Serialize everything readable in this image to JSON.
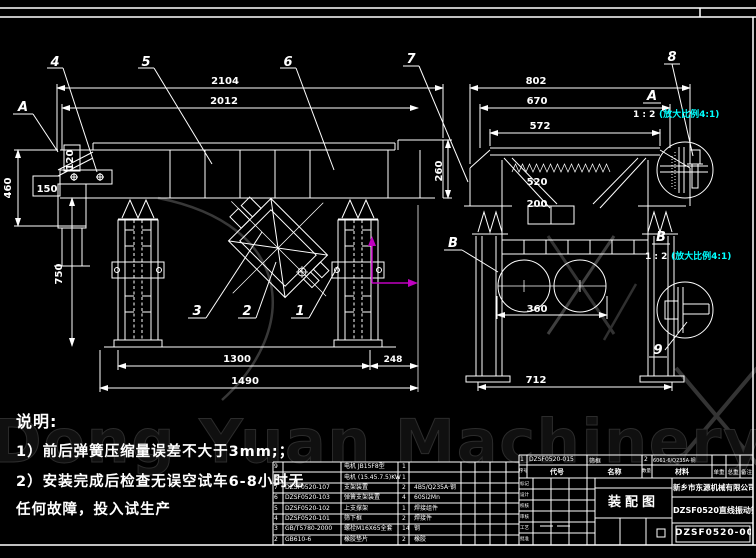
{
  "watermark": {
    "text": "Dong Yuan Machinery"
  },
  "notes": {
    "title": "说明:",
    "line1": "1）前后弹簧压缩量误差不大于3mm;；",
    "line2": "2）安装完成后检查无误空试车6-8小时无",
    "line3": "任何故障，投入试生产"
  },
  "side_view": {
    "marker_a": "A",
    "balloons": {
      "b1": "1",
      "b2": "2",
      "b3": "3",
      "b4": "4",
      "b5": "5",
      "b6": "6"
    },
    "dims": {
      "d2104": "2104",
      "d2012": "2012",
      "d460": "460",
      "d120": "120",
      "d150": "150",
      "d260": "260",
      "d750": "750",
      "d1300": "1300",
      "d248": "248",
      "d1490": "1490"
    }
  },
  "front_view": {
    "marker_b": "B",
    "balloons": {
      "b7": "7"
    },
    "dims": {
      "d802": "802",
      "d670": "670",
      "d572": "572",
      "d520": "520",
      "d200": "200",
      "d360": "360",
      "d712": "712"
    }
  },
  "details": {
    "a": {
      "label": "A",
      "scale": "1 : 2",
      "note": "(放大比例4:1)",
      "balloon": "8"
    },
    "b": {
      "label": "B",
      "scale": "1 : 2",
      "note": "(放大比例4:1)",
      "balloon": "9"
    }
  },
  "bom": {
    "rows": [
      {
        "no": "9",
        "code": "",
        "name": "电机 JB15F8型",
        "qty": "1",
        "material": ""
      },
      {
        "no": "8",
        "code": "",
        "name": "电机 (15.45.7.5)KW",
        "qty": "1",
        "material": ""
      },
      {
        "no": "7",
        "code": "DZSF0520-107",
        "name": "支架装置",
        "qty": "2",
        "material": "4B5/Q235A·钢"
      },
      {
        "no": "6",
        "code": "DZSF0520-103",
        "name": "弹簧支架装置",
        "qty": "4",
        "material": "60Si2Mn"
      },
      {
        "no": "5",
        "code": "DZSF0520-102",
        "name": "上支撑架",
        "qty": "1",
        "material": "焊接组件"
      },
      {
        "no": "4",
        "code": "DZSF0520-101",
        "name": "筛下框",
        "qty": "2",
        "material": "焊接件"
      },
      {
        "no": "3",
        "code": "GB/T5780-2000",
        "name": "螺栓M16X65全套",
        "qty": "14",
        "material": "钢"
      },
      {
        "no": "2",
        "code": "GB610-6",
        "name": "橡胶垫片",
        "qty": "2",
        "material": "橡胶"
      }
    ]
  },
  "title_block": {
    "row1": {
      "no": "1",
      "code": "DZSF0520-015",
      "name": "筛框",
      "qty": "2",
      "material": "6061·6/Q235A·钢"
    },
    "header": {
      "no": "序号",
      "code": "代号",
      "name": "名称",
      "qty": "数量",
      "material": "材料",
      "unit_weight": "单重",
      "total_weight": "总重",
      "remark": "备注"
    },
    "left_labels": [
      "标记",
      "设计",
      "校核",
      "审核",
      "工艺",
      "批准"
    ],
    "doc_type": "装配图",
    "company": "新乡市东源机械有限公司",
    "product": "DZSF0520直线振动筛",
    "drawing_no": "DZSF0520-000"
  },
  "colors": {
    "line": "#ffffff",
    "cyan": "#00ffff",
    "magenta": "#c000c0",
    "background": "#000000"
  }
}
